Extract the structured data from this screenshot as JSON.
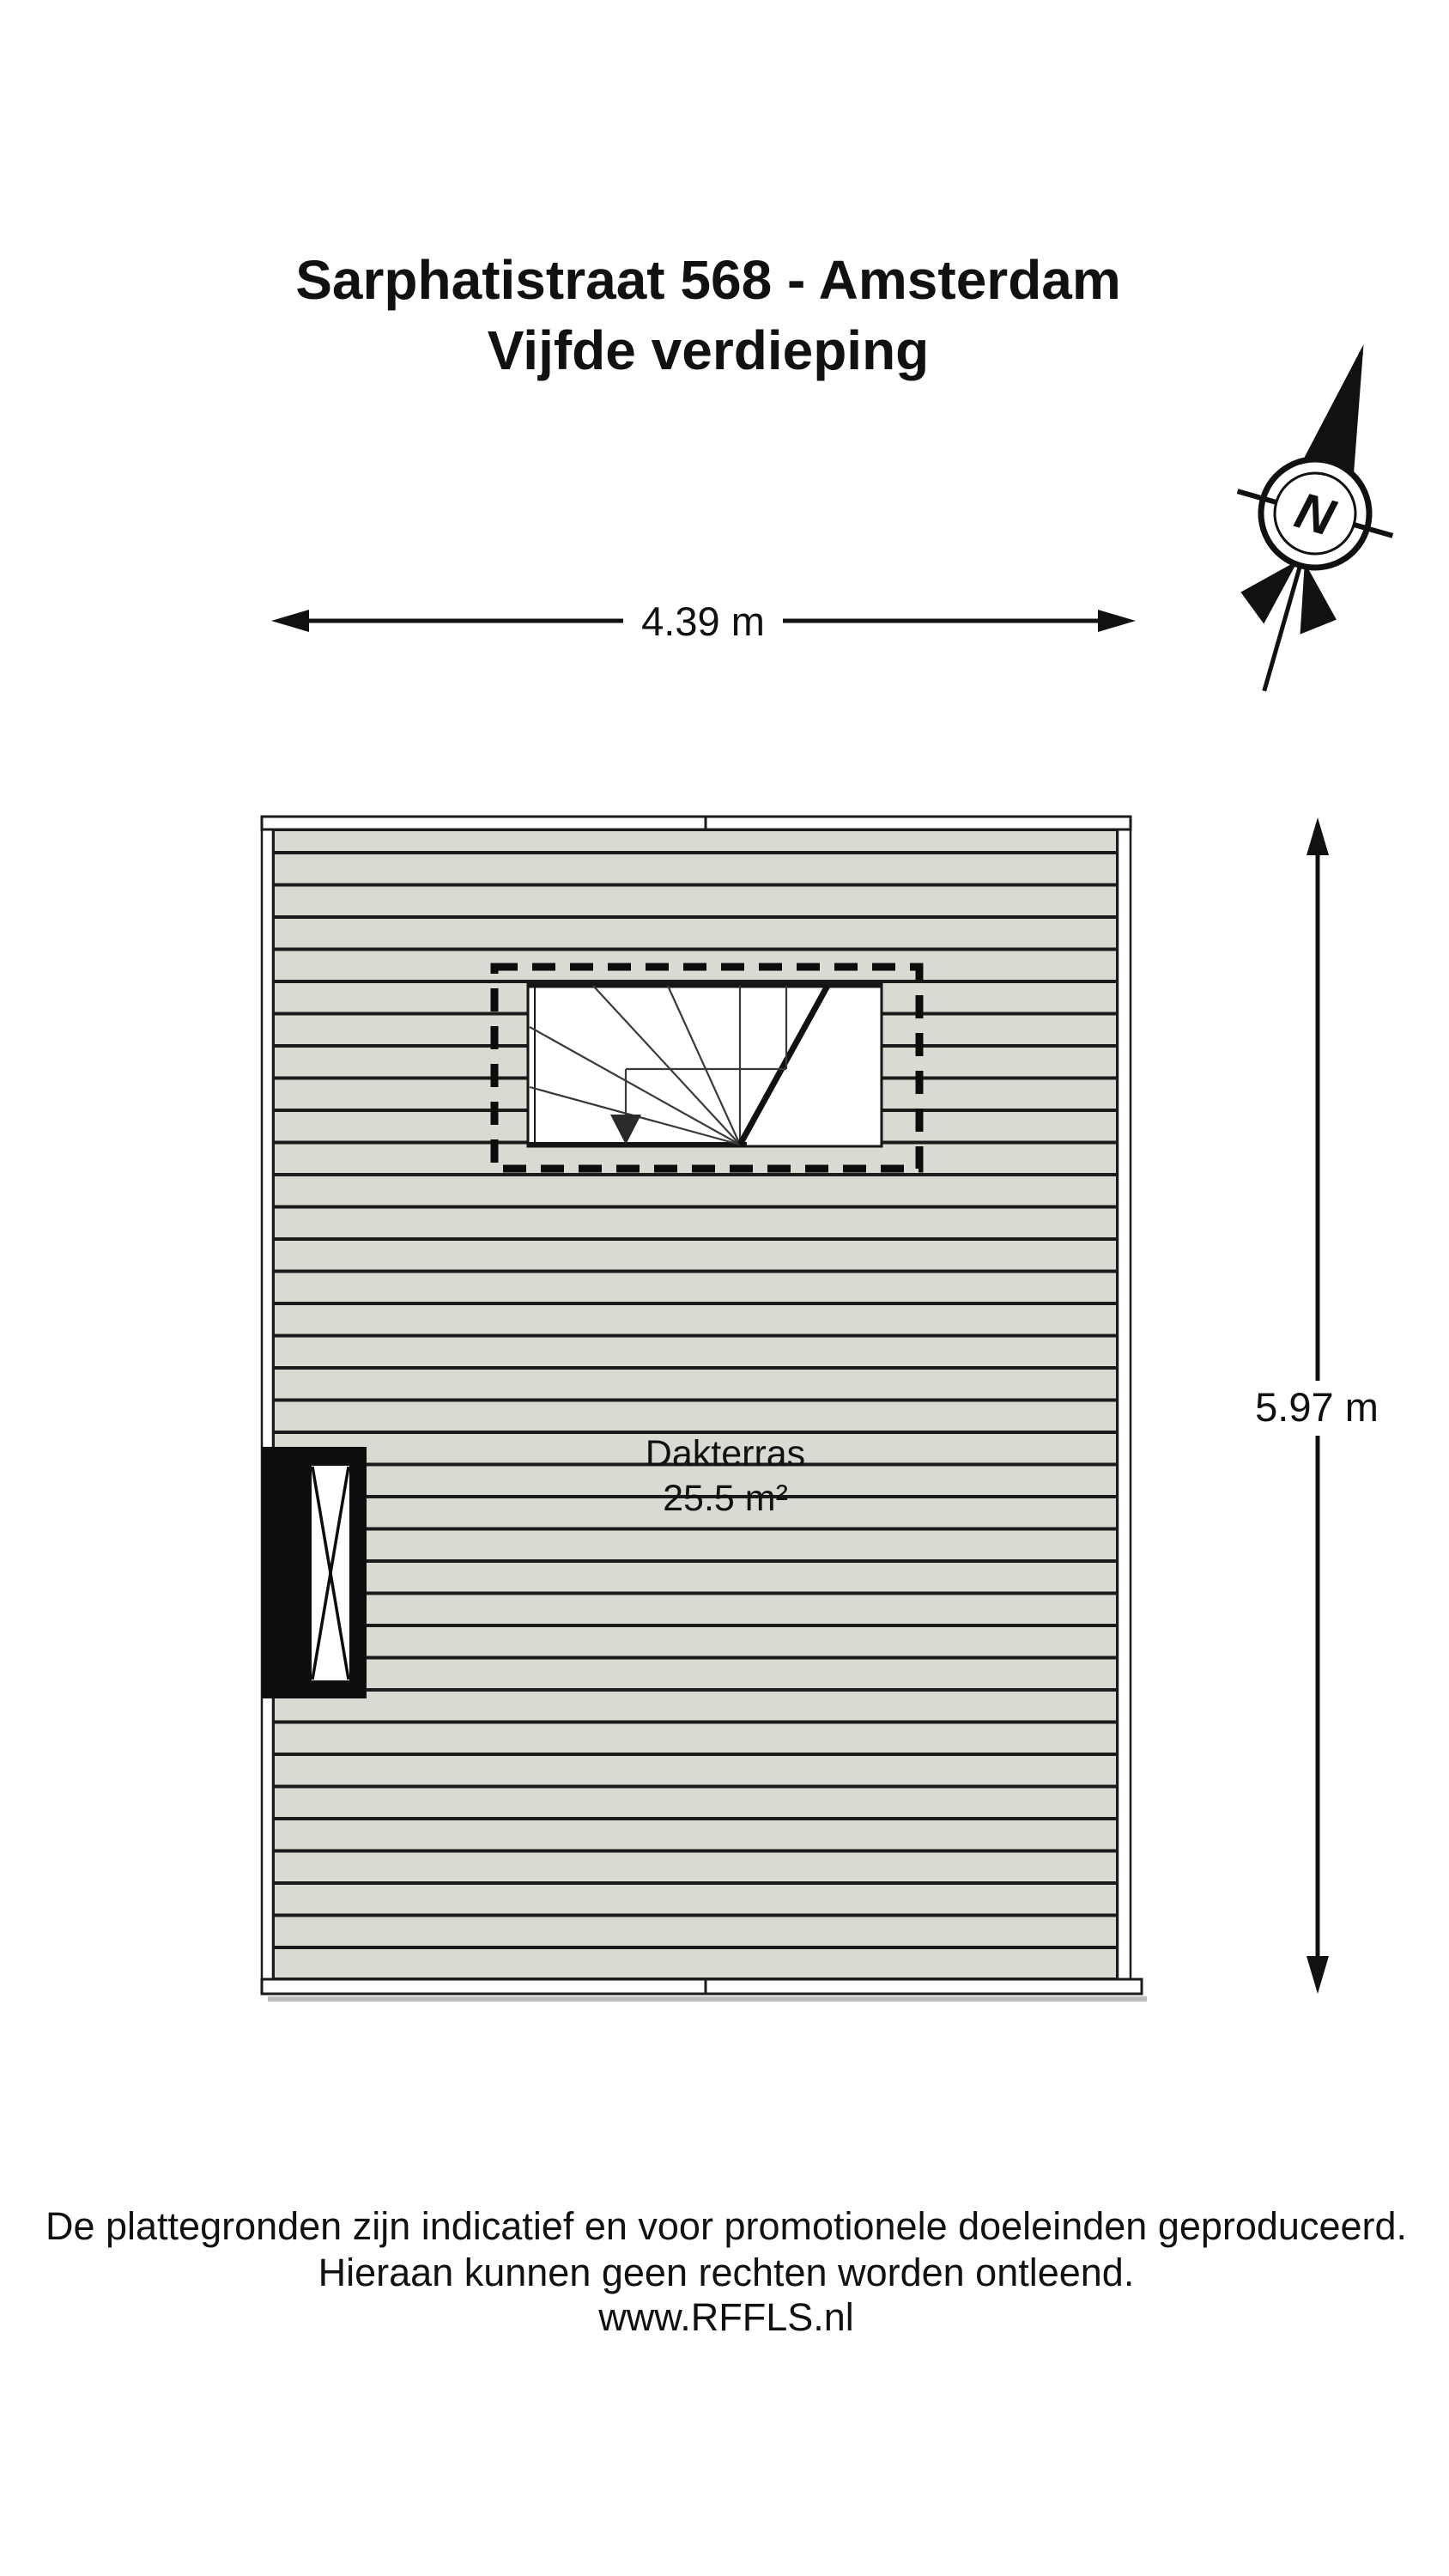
{
  "title": {
    "line1": "Sarphatistraat 568 - Amsterdam",
    "line2": "Vijfde verdieping"
  },
  "compass": {
    "north_label": "N"
  },
  "dimensions": {
    "width_label": "4.39 m",
    "height_label": "5.97 m"
  },
  "room": {
    "name": "Dakterras",
    "area": "25.5 m²"
  },
  "footer": {
    "line1": "De plattegronden zijn indicatief en voor promotionele doeleinden geproduceerd.",
    "line2": "Hieraan kunnen geen rechten worden ontleend.",
    "line3": "www.RFFLS.nl"
  },
  "colors": {
    "deck_fill": "#dadad2",
    "line": "#1b1b1b",
    "background": "#ffffff"
  }
}
